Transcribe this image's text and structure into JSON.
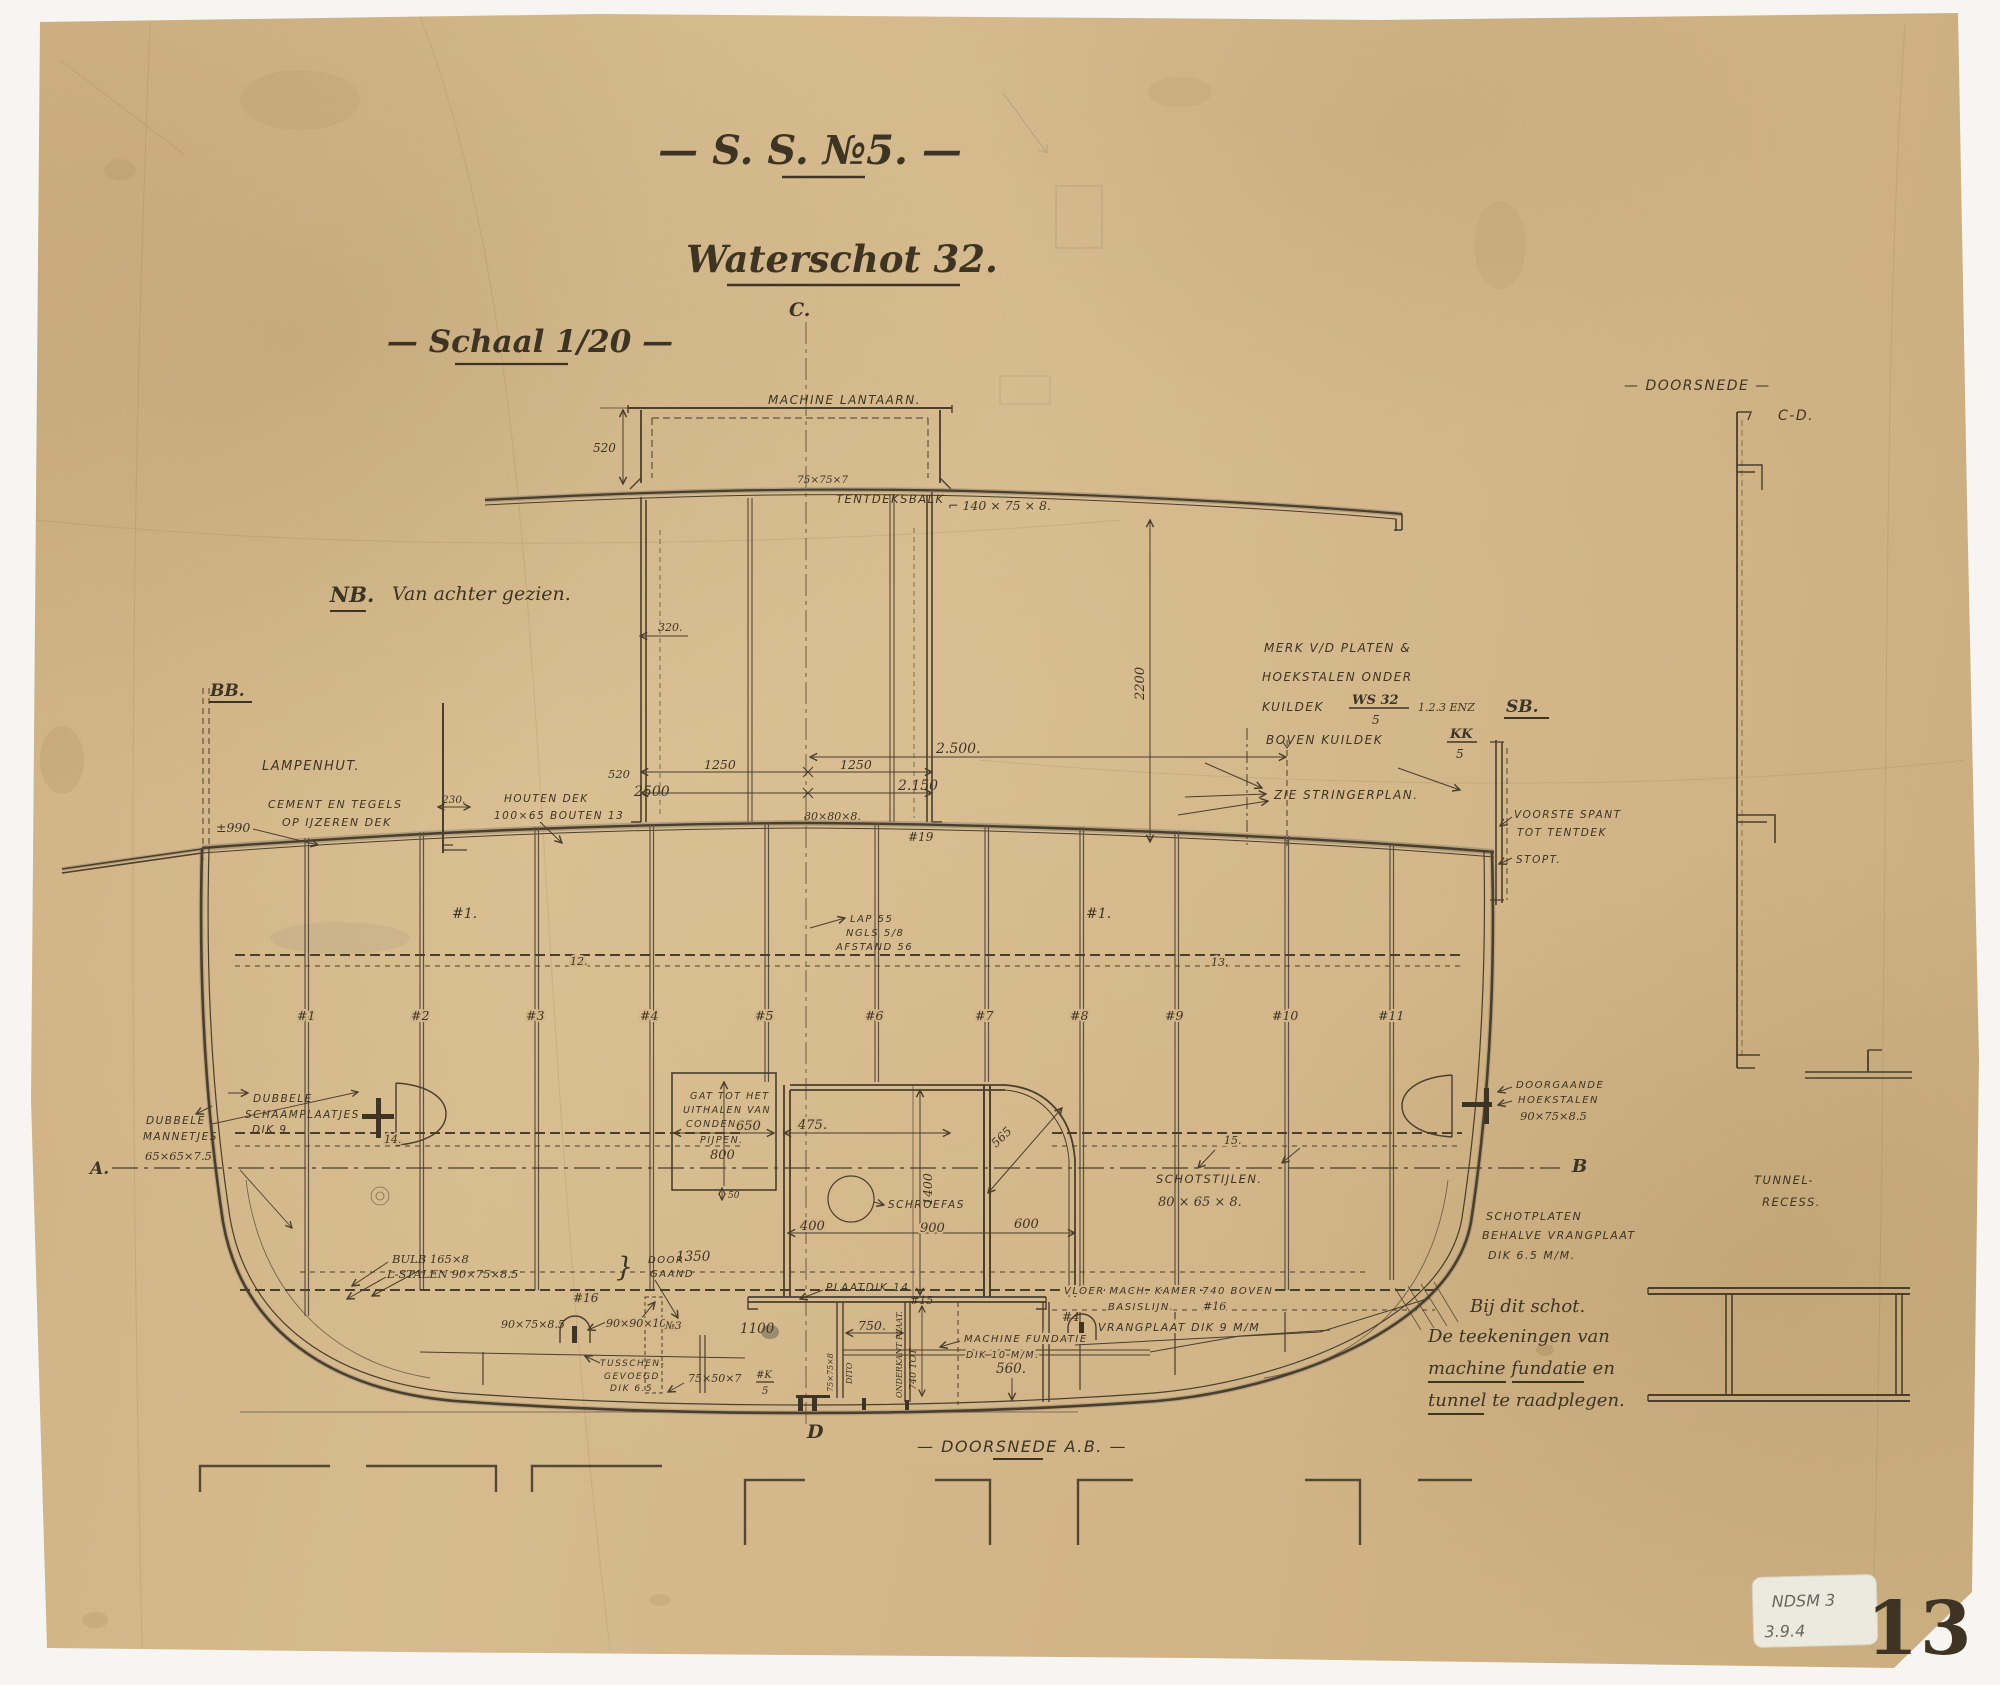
{
  "drawing": {
    "type": "ship-bulkhead-section-blueprint",
    "colors": {
      "paper": "#d3b789",
      "ink": "#3e3424",
      "line": "#4a3e2c",
      "pencil": "#8f7f63",
      "sticker": "#eceadf",
      "stencil": "#2e2b26"
    }
  },
  "t": {
    "title": "— S. S. №5. —",
    "subtitle": "Waterschot 32.",
    "scale": "— Schaal 1/20 —",
    "c_mark": "C.",
    "d_mark": "D",
    "machine_lantaarn": "MACHINE LANTAARN.",
    "dim_520_lantern": "520",
    "dim_320": "320.",
    "angle_75757": "75×75×7",
    "tentdeksbalk": "TENTDEKSBALK",
    "tentdeksbalk_size": "⌐ 140 × 75 × 8.",
    "nb_note": "NB.",
    "nb_note2": "Van achter gezien.",
    "merk1": "MERK V/D PLATEN &",
    "merk2": "HOEKSTALEN ONDER",
    "merk3": "KUILDEK",
    "merk_ws": "WS 32",
    "merk_ws_den": "5",
    "merk_enz": "1.2.3 ENZ",
    "merk4": "BOVEN KUILDEK",
    "merk_kk": "KK",
    "merk_kk_den": "5",
    "bb": "BB.",
    "sb": "SB.",
    "doorsnede_top": "— DOORSNEDE —",
    "cd": "C-D.",
    "lampenhut": "LAMPENHUT.",
    "cement1": "CEMENT EN TEGELS",
    "cement2": "OP IJZEREN DEK",
    "dim_990": "±990",
    "dim_230": "230.",
    "houten1": "HOUTEN DEK",
    "houten2": "100×65  BOUTEN 13",
    "dim_520_casing": "520",
    "dim_2500a": "2500",
    "dim_1250a": "1250",
    "dim_1250b": "1250",
    "dim_2500b": "2.500.",
    "dim_2150": "2.150",
    "dim_2200": "2200",
    "angle_80808": "80×80×8.",
    "fr19": "#19",
    "zie_stringerplan": "ZIE STRINGERPLAN.",
    "voorste1": "VOORSTE SPANT",
    "voorste2": "TOT TENTDEK",
    "stopt": "STOPT.",
    "mark1_left": "#1.",
    "mark1_right": "#1.",
    "lap1": "LAP 55",
    "lap2": "NGLS 5/8",
    "lap3": "AFSTAND 56",
    "s12": "12.",
    "s13": "13.",
    "s14": "14.",
    "s15": "15.",
    "frames": [
      "#1",
      "#2",
      "#3",
      "#4",
      "#5",
      "#6",
      "#7",
      "#8",
      "#9",
      "#10",
      "#11"
    ],
    "schaam1": "DUBBELE",
    "schaam2": "SCHAAMPLAATJES",
    "schaam3": "DIK 9",
    "man1": "DUBBELE",
    "man2": "MANNETJES",
    "man3": "65×65×7.5",
    "a_mark": "A.",
    "b_mark": "B",
    "gat1": "GAT TOT HET",
    "gat2": "UITHALEN VAN",
    "gat3": "CONDENSOR",
    "gat4": "PIJPEN.",
    "gat5": "800",
    "dim_650": "650",
    "dim_475": "475.",
    "dim_50": "50",
    "schroefas": "SCHROEFAS",
    "dim_1400": "1400",
    "dim_400": "400",
    "dim_900": "900",
    "dim_600": "600",
    "dim_565": "565",
    "stijlen1": "SCHOTSTIJLEN.",
    "stijlen2": "80 × 65 × 8.",
    "doorg1": "DOORGAANDE",
    "doorg2": "HOEKSTALEN",
    "doorg3": "90×75×8.5",
    "tunnel1": "TUNNEL-",
    "tunnel2": "RECESS.",
    "schotp1": "SCHOTPLATEN",
    "schotp2": "BEHALVE VRANGPLAAT",
    "schotp3": "DIK 6.5 M/M.",
    "bulb1": "BULB 165×8",
    "bulb2": "L-STALEN 90×75×8.5",
    "brace": "}",
    "doorgd1": "DOOR-",
    "doorgd2": "GAAND",
    "dim_1350": "1350",
    "fr16a": "#16",
    "angle_90758": "90×75×8.5",
    "angle_909010": "90×90×10",
    "no3": "№3",
    "dim_1100": "1100",
    "tus1": "TUSSCHEN-",
    "tus2": "GEVOEGD",
    "tus3": "DIK 6.5",
    "angle_75507": "75×50×7",
    "k_num": "#K",
    "k_den": "5",
    "plaatdik": "PLAATDIK 14.",
    "fr15": "#15",
    "dim_750": "750.",
    "vert_7575": "75×75×8",
    "vert_dito": "DITO",
    "vert_740": "740 TOT",
    "vert_onderkant": "ONDERKANT PLAAT.",
    "mf1": "MACHINE FUNDATIE",
    "mf2": "DIK 10 M/M.",
    "dim_560": "560.",
    "fr4": "#4",
    "vrangplaat": "VRANGPLAAT DIK 9 M/M",
    "vloer1": "VLOER MACH. KAMER 740 BOVEN",
    "vloer2": "BASISLIJN.",
    "fr16b": "#16",
    "doorsnede_ab": "— DOORSNEDE A.B. —",
    "note1": "Bij dit schot.",
    "note2": "De teekeningen van",
    "note3": "machine fundatie en",
    "note4": "tunnel te raadplegen.",
    "sticker1": "NDSM 3",
    "sticker2": "3.9.4",
    "sheet_no": "13"
  }
}
